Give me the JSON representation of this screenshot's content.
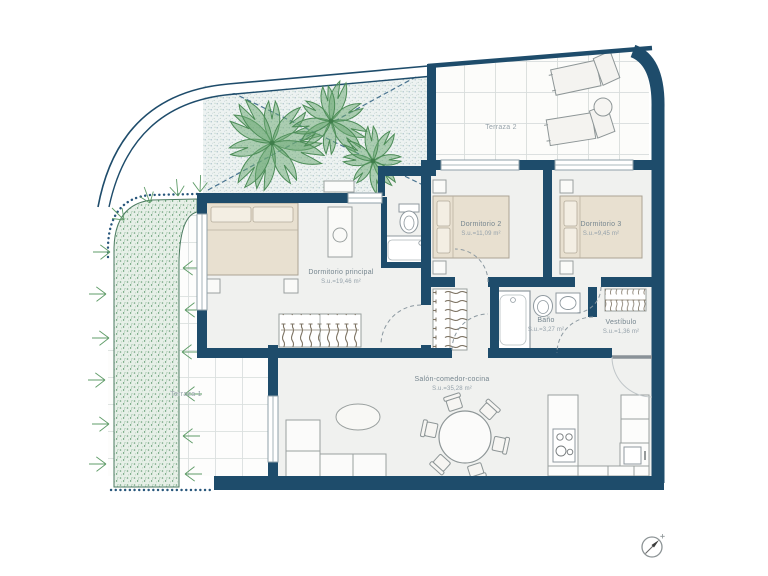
{
  "plan": {
    "type": "apartment-floor-plan",
    "unit_label_prefix": "S.u.="
  },
  "colors": {
    "wall": "#1e4c6b",
    "bed_fill": "#e8e0d0",
    "vegetation_green": "#55975f",
    "label_text": "#76868f",
    "area_text": "#94a1aa"
  },
  "rooms": [
    {
      "id": "terraza-2",
      "name": "Terraza 2",
      "area": ""
    },
    {
      "id": "dormitorio-2",
      "name": "Dormitorio 2",
      "area": "S.u.=11,09 m²"
    },
    {
      "id": "dormitorio-3",
      "name": "Dormitorio 3",
      "area": "S.u.=9,45 m²"
    },
    {
      "id": "dormitorio-principal",
      "name": "Dormitorio principal",
      "area": "S.u.=19,46 m²"
    },
    {
      "id": "bano",
      "name": "Baño",
      "area": "S.u.=3,27 m²"
    },
    {
      "id": "vestibulo",
      "name": "Vestíbulo",
      "area": "S.u.=1,36 m²"
    },
    {
      "id": "salon",
      "name": "Salón-comedor-cocina",
      "area": "S.u.=35,28 m²"
    },
    {
      "id": "terraza-1",
      "name": "Terraza 1",
      "area": ""
    }
  ],
  "icons": {
    "compass": "north-compass-icon"
  }
}
